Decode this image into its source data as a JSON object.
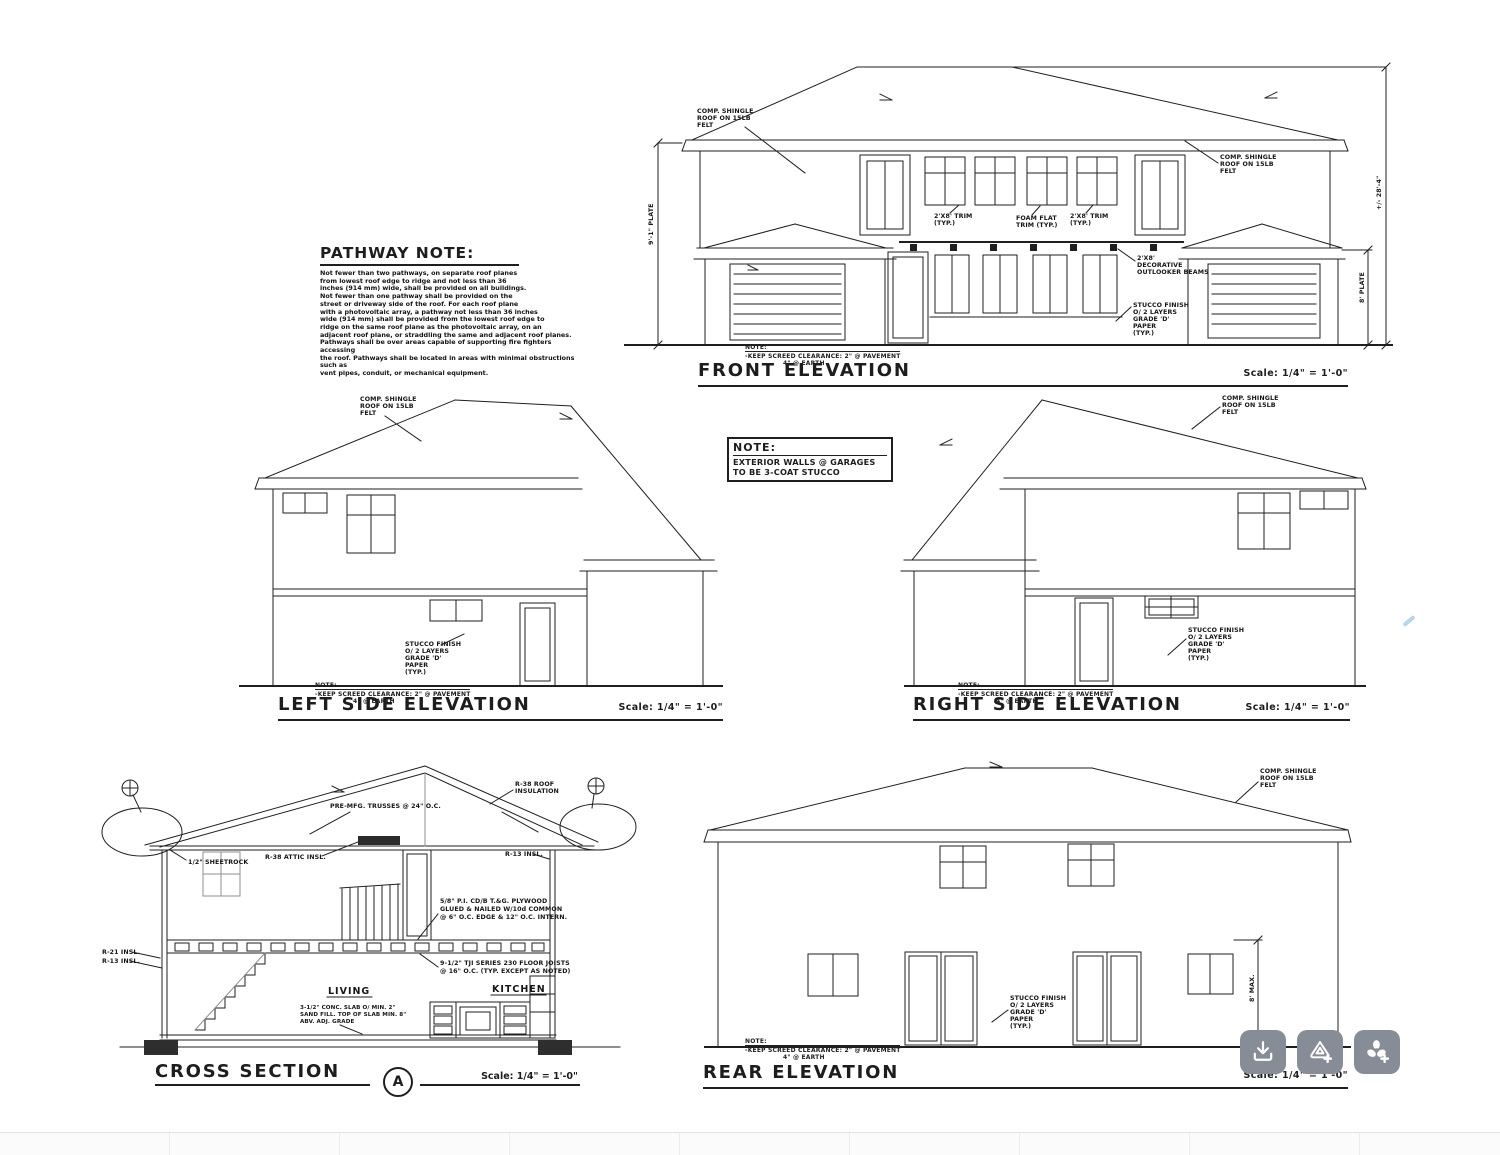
{
  "titles": {
    "front": "FRONT ELEVATION",
    "left": "LEFT SIDE ELEVATION",
    "right": "RIGHT SIDE ELEVATION",
    "cross": "CROSS SECTION",
    "rear": "REAR ELEVATION",
    "section_marker": "A"
  },
  "scale_label": "Scale: 1/4\" = 1'-0\"",
  "screed_note": {
    "title": "NOTE:",
    "line1": "-KEEP SCREED CLEARANCE: 2\" @ PAVEMENT",
    "line2": "4\" @ EARTH"
  },
  "pathway_note": {
    "title": "PATHWAY NOTE:",
    "lines": [
      "Not fewer than two pathways, on separate roof planes",
      "from lowest roof edge to ridge and not less than 36",
      "inches (914 mm) wide, shall be provided on all buildings.",
      "Not fewer than one pathway shall be provided on the",
      "street or driveway side of the roof. For each roof plane",
      "with a photovoltaic array, a pathway not less than 36 inches",
      "wide (914 mm) shall be provided from the lowest roof edge to",
      "ridge on the same roof plane as the photovoltaic array, on an",
      "adjacent roof plane, or straddling the same and adjacent roof planes.",
      "Pathways shall be over areas capable of supporting fire fighters accessing",
      "the roof. Pathways shall be located in areas with minimal obstructions such as",
      "vent pipes, conduit, or mechanical equipment."
    ]
  },
  "stucco_note": {
    "title": "NOTE:",
    "line1": "EXTERIOR WALLS @ GARAGES",
    "line2": "TO BE 3-COAT STUCCO"
  },
  "ann": {
    "comp_shingle": [
      "COMP. SHINGLE",
      "ROOF ON 15LB",
      "FELT"
    ],
    "stucco_finish": [
      "STUCCO FINISH",
      "O/ 2 LAYERS",
      "GRADE 'D'",
      "PAPER",
      "(TYP.)"
    ],
    "outlooker": [
      "2'X8'",
      "DECORATIVE",
      "OUTLOOKER BEAMS"
    ],
    "trim": [
      "2'X8' TRIM",
      "(TYP.)"
    ],
    "trim_flat": [
      "FOAM FLAT",
      "TRIM (TYP.)"
    ],
    "plate9": "9'-1\" PLATE",
    "plate8": "8' PLATE",
    "height_overall": "+/- 28'-4\"",
    "max8": "8' MAX.",
    "trusses": "PRE-MFG. TRUSSES @ 24\" O.C.",
    "attic_insl": "R-38 ATTIC INSL.",
    "roof_insl": [
      "R-38 ROOF",
      "INSULATION"
    ],
    "r13": "R-13 INSL.",
    "r21": "R-21 INSL.",
    "sheetrock": "1/2\" SHEETROCK",
    "plywood": [
      "5/8\" P.I. CD/B T.&G. PLYWOOD",
      "GLUED & NAILED W/10d COMMON",
      "@ 6\" O.C. EDGE & 12\" O.C. INTERN."
    ],
    "joists": [
      "9-1/2\" TJI SERIES 230 FLOOR JOISTS",
      "@ 16\" O.C. (TYP. EXCEPT AS NOTED)"
    ],
    "living": "LIVING",
    "kitchen": "KITCHEN",
    "slab": [
      "3-1/2\" CONC. SLAB O/ MIN. 2\"",
      "SAND FILL. TOP OF SLAB MIN. 8\"",
      "ABV. ADJ. GRADE"
    ]
  },
  "toolbar": {
    "icons": [
      "download-icon",
      "triangle-plus-icon",
      "pinwheel-plus-icon"
    ]
  }
}
